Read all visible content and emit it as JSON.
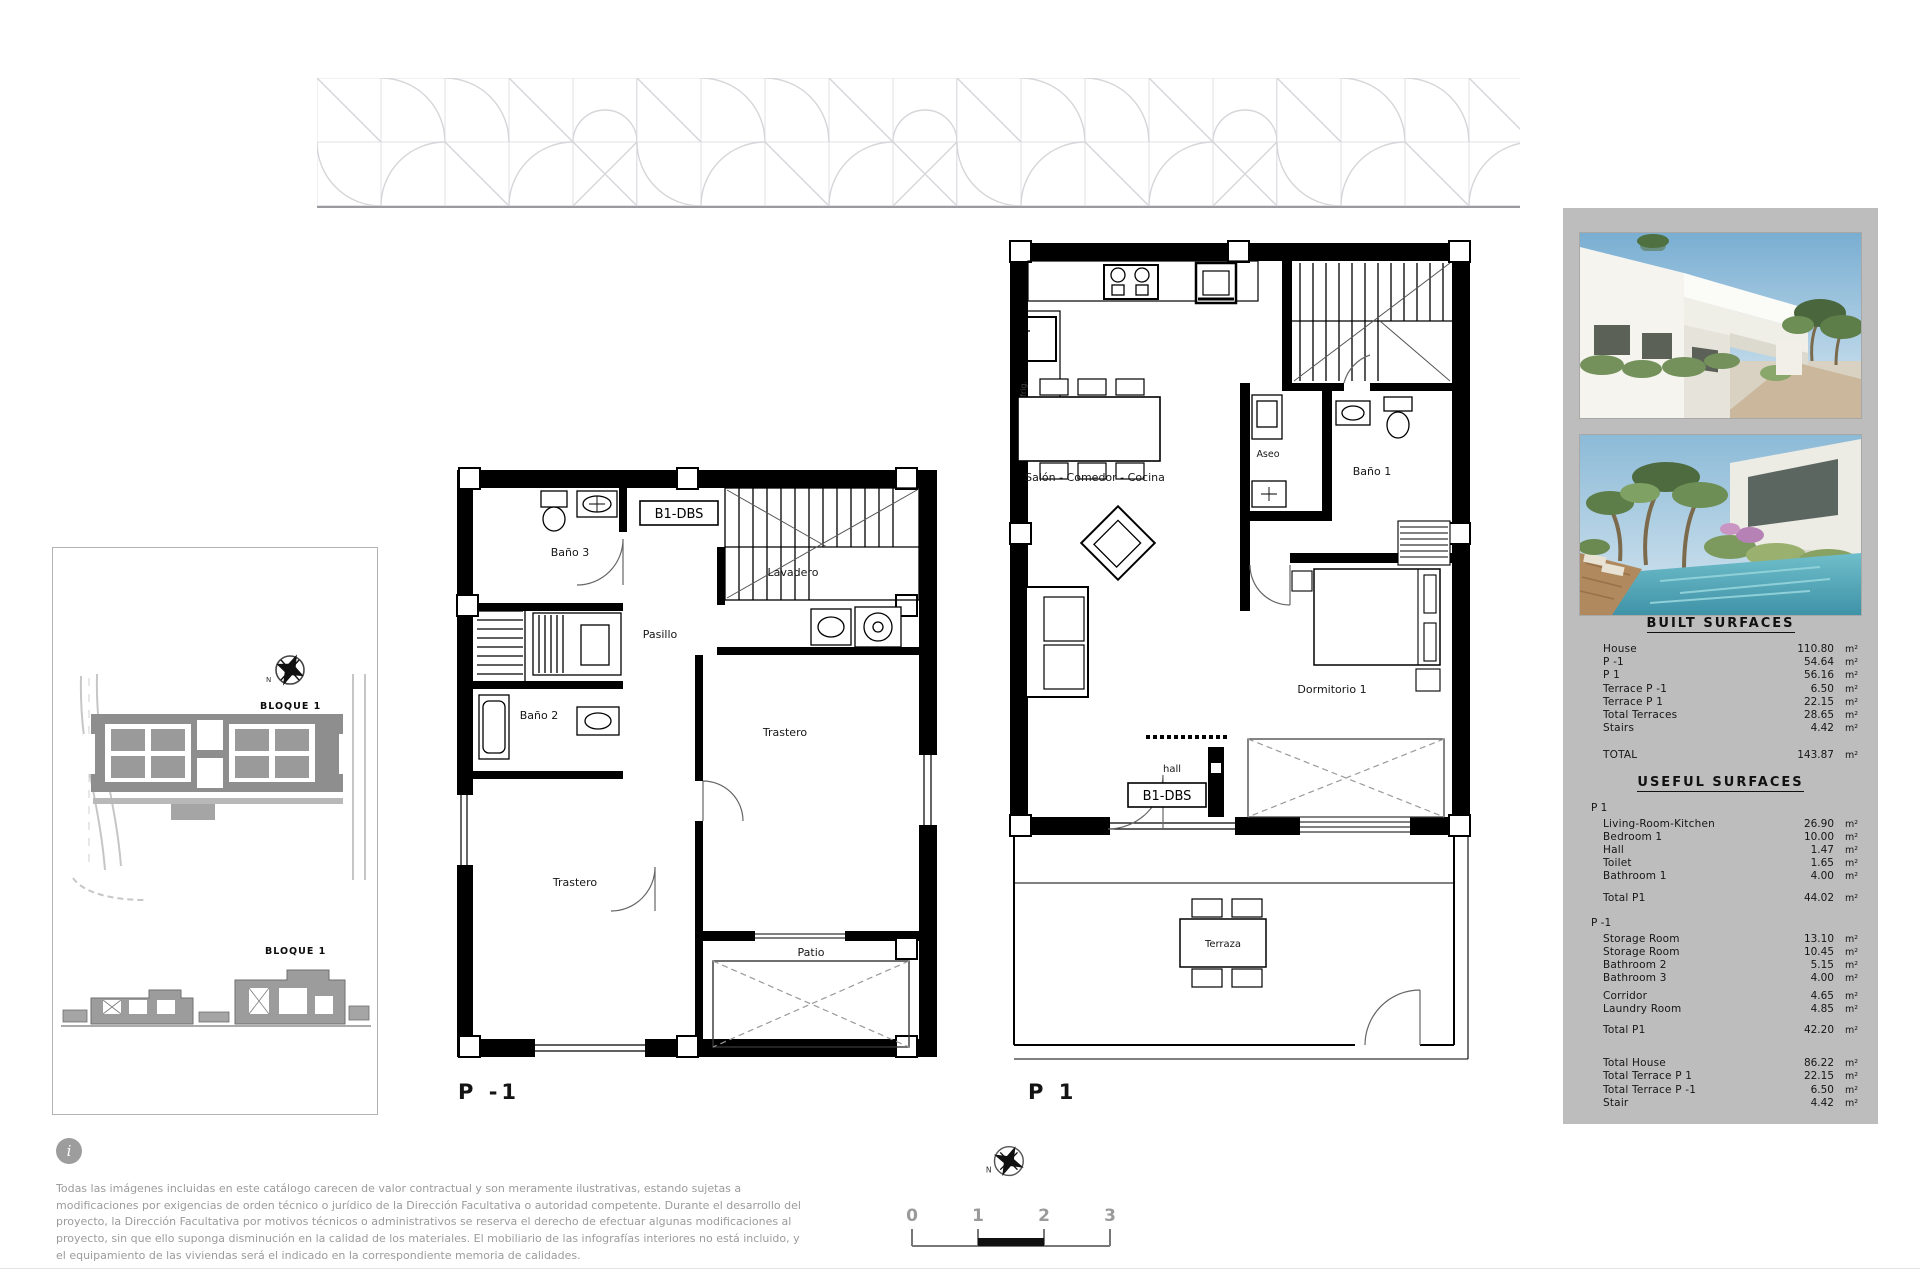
{
  "site_plan": {
    "bloque_top": "BLOQUE 1",
    "bloque_bottom": "BLOQUE 1",
    "north_label": "N"
  },
  "plans": {
    "p_minus_1": {
      "title": "P -1",
      "unit_label": "B1-DBS",
      "rooms": {
        "bano3": "Baño 3",
        "lavadero": "Lavadero",
        "pasillo": "Pasillo",
        "bano2": "Baño 2",
        "trastero_right": "Trastero",
        "trastero_left": "Trastero",
        "patio": "Patio"
      }
    },
    "p_1": {
      "title": "P 1",
      "unit_label": "B1-DBS",
      "rooms": {
        "salon": "Salón - Comedor - Cocina",
        "aseo": "Aseo",
        "bano1": "Baño 1",
        "dormitorio1": "Dormitorio 1",
        "hall": "hall",
        "terraza": "Terraza",
        "frig": "frig."
      }
    }
  },
  "surfaces": {
    "built": {
      "title": "BUILT SURFACES",
      "rows": [
        {
          "label": "House",
          "value": "110.80",
          "unit": "m²"
        },
        {
          "label": "P -1",
          "value": "54.64",
          "unit": "m²"
        },
        {
          "label": "P 1",
          "value": "56.16",
          "unit": "m²"
        },
        {
          "label": "Terrace  P -1",
          "value": "6.50",
          "unit": "m²"
        },
        {
          "label": "Terrace  P 1",
          "value": "22.15",
          "unit": "m²"
        },
        {
          "label": "Total Terraces",
          "value": "28.65",
          "unit": "m²"
        },
        {
          "label": "Stairs",
          "value": "4.42",
          "unit": "m²"
        }
      ],
      "total": {
        "label": "TOTAL",
        "value": "143.87",
        "unit": "m²"
      }
    },
    "useful": {
      "title": "USEFUL SURFACES",
      "p1_section": {
        "header": "P 1",
        "rows": [
          {
            "label": "Living-Room-Kitchen",
            "value": "26.90",
            "unit": "m²"
          },
          {
            "label": "Bedroom 1",
            "value": "10.00",
            "unit": "m²"
          },
          {
            "label": "Hall",
            "value": "1.47",
            "unit": "m²"
          },
          {
            "label": "Toilet",
            "value": "1.65",
            "unit": "m²"
          },
          {
            "label": "Bathroom 1",
            "value": "4.00",
            "unit": "m²"
          }
        ],
        "total": {
          "label": "Total P1",
          "value": "44.02",
          "unit": "m²"
        }
      },
      "pm1_section": {
        "header": "P -1",
        "rows": [
          {
            "label": "Storage Room",
            "value": "13.10",
            "unit": "m²"
          },
          {
            "label": "Storage Room",
            "value": "10.45",
            "unit": "m²"
          },
          {
            "label": "Bathroom 2",
            "value": "5.15",
            "unit": "m²"
          },
          {
            "label": "Bathroom 3",
            "value": "4.00",
            "unit": "m²"
          },
          {
            "label": "Corridor",
            "value": "4.65",
            "unit": "m²"
          },
          {
            "label": "Laundry Room",
            "value": "4.85",
            "unit": "m²"
          }
        ],
        "total": {
          "label": "Total P1",
          "value": "42.20",
          "unit": "m²"
        }
      },
      "summary": [
        {
          "label": "Total House",
          "value": "86.22",
          "unit": "m²"
        },
        {
          "label": "Total Terrace  P 1",
          "value": "22.15",
          "unit": "m²"
        },
        {
          "label": "Total Terrace  P -1",
          "value": "6.50",
          "unit": "m²"
        },
        {
          "label": "Stair",
          "value": "4.42",
          "unit": "m²"
        }
      ]
    }
  },
  "scale_bar": {
    "labels": [
      "0",
      "1",
      "2",
      "3"
    ],
    "north_label": "N"
  },
  "disclaimer": {
    "icon": "i",
    "text": "Todas las imágenes incluidas en este catálogo carecen de valor contractual y son meramente ilustrativas, estando sujetas a modificaciones por exigencias de orden técnico o jurídico de la Dirección Facultativa o autoridad competente. Durante el desarrollo del proyecto, la Dirección Facultativa por motivos técnicos o administrativos se reserva el derecho de efectuar algunas modificaciones al proyecto, sin que ello suponga disminución en la calidad de los materiales. El mobiliario de las infografías interiores no está incluido, y el equipamiento de las viviendas será el indicado en la correspondiente memoria de calidades."
  }
}
